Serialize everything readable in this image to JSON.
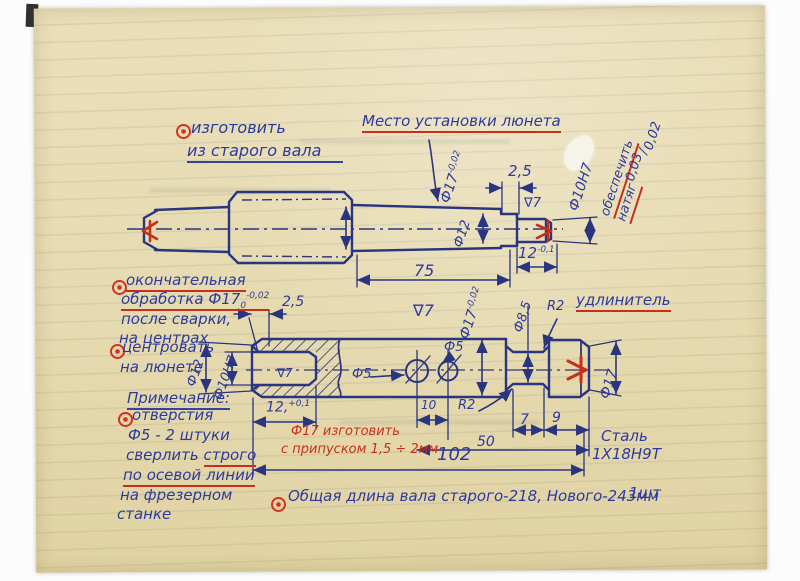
{
  "doc": {
    "top_note": {
      "l1": "изготовить",
      "l2": "из старого вала"
    },
    "lunette": "Место установки люнета",
    "fit": {
      "w1": "обеспечить",
      "w2": "натяг",
      "num": "0,03",
      "den": "0,02"
    },
    "left_notes": {
      "fin1": "окончательная",
      "fin2": "обработка Ф17",
      "fin2_sub": "0",
      "fin2_sup": "-0,02",
      "fin3": "после сварки,",
      "fin4": "на центрах",
      "cen1": "центровать",
      "cen2": "на люнете",
      "note_title": "Примечание:",
      "h1": "отверстия",
      "h2": "Ф5 - 2 штуки",
      "h3a": "сверлить ",
      "h3b": "строго",
      "h4": "по осевой линии",
      "h5": "на фрезерном",
      "h6": "станке"
    },
    "allow1": "Ф17 изготовить",
    "allow2": "с припуском 1,5 ÷ 2мм",
    "extension": "удлинитель",
    "steel1": "Сталь",
    "steel2": "1Х18Н9Т",
    "total": "Общая длина вала старого-218,  Нового-243мм",
    "qty": "1шт"
  },
  "top": {
    "d17": "Ф17",
    "d17sup": "-0,02",
    "c25": "2,5",
    "d12": "Ф12",
    "f7": "∇7",
    "l75": "75",
    "l12": "12",
    "l12sup": "-0,1",
    "d10": "Ф10Н7"
  },
  "bot": {
    "c25": "2,5",
    "f7": "∇7",
    "d17": "Ф17",
    "d17sup": "-0,02",
    "d85": "Ф8,5",
    "r2a": "R2",
    "d17r": "Ф17",
    "d12": "Ф12",
    "d10": "Ф10Н7",
    "f7b": "∇7",
    "dep12": "12,",
    "dep12sup": "+0,1",
    "d5a": "Ф5",
    "d5b": "Ф5",
    "l10": "10",
    "r2b": "R2",
    "l7": "7",
    "l9": "9",
    "l50": "50",
    "l102": "102"
  },
  "colors": {
    "ink_blue": "#2c3a9e",
    "ink_red": "#c5301d",
    "paper": "#e6dab0"
  }
}
